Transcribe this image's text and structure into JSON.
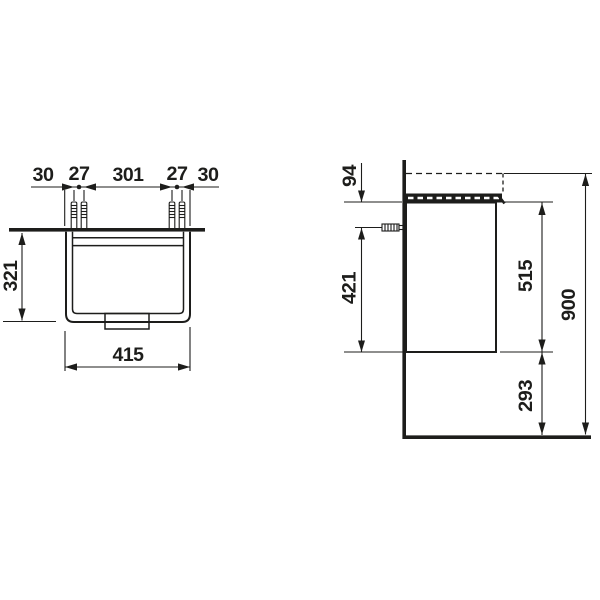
{
  "drawing": {
    "background": "#ffffff",
    "line_color": "#1d1d1b",
    "plan_view": {
      "offset_left": "30",
      "hole_pair_left": "27",
      "hole_span": "301",
      "hole_pair_right": "27",
      "offset_right": "30",
      "depth": "321",
      "width": "415"
    },
    "side_view": {
      "basin_rim": "94",
      "anchor_to_bottom": "421",
      "body_height": "515",
      "total_height": "900",
      "floor_clearance": "293"
    }
  }
}
